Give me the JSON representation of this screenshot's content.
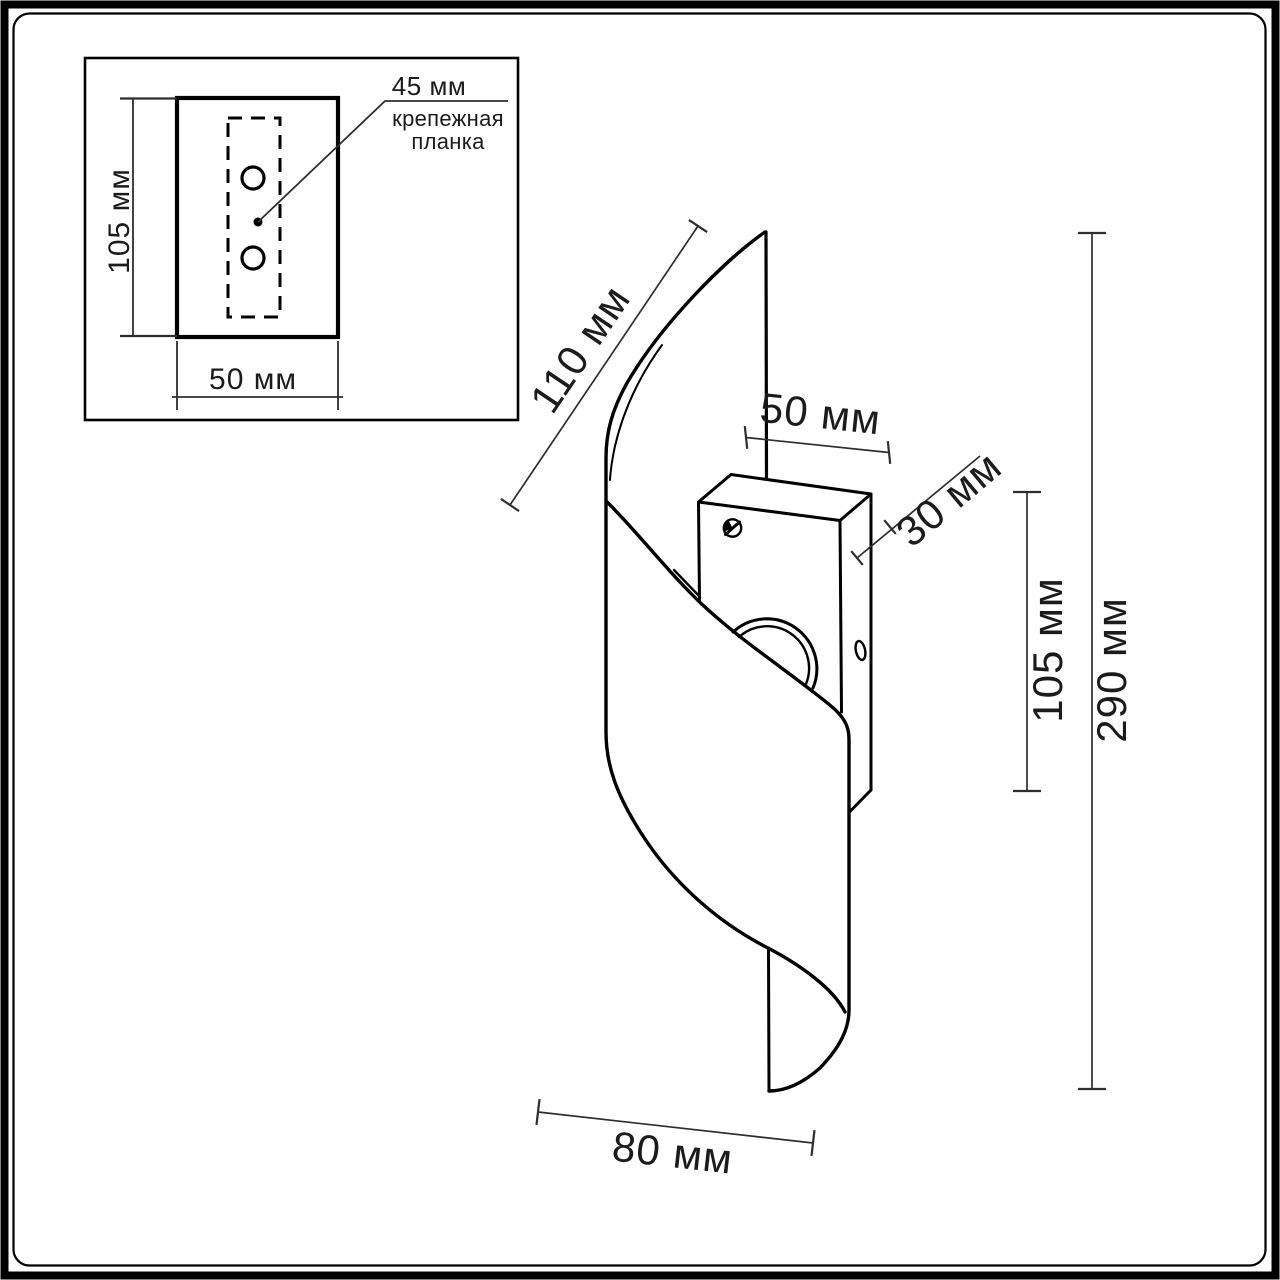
{
  "colors": {
    "background": "#ffffff",
    "ink": "#000000",
    "dimension": "#2e2e2e",
    "text": "#1b1b1b"
  },
  "inset": {
    "height_label": "105 мм",
    "width_label": "50 мм",
    "bar_width_label": "45 мм",
    "bar_name_line1": "крепежная",
    "bar_name_line2": "планка"
  },
  "main": {
    "shade_edge_label": "110 мм",
    "box_width_label": "50 мм",
    "box_depth_label": "30 мм",
    "box_height_label": "105 мм",
    "overall_height_label": "290 мм",
    "bottom_width_label": "80 мм"
  }
}
